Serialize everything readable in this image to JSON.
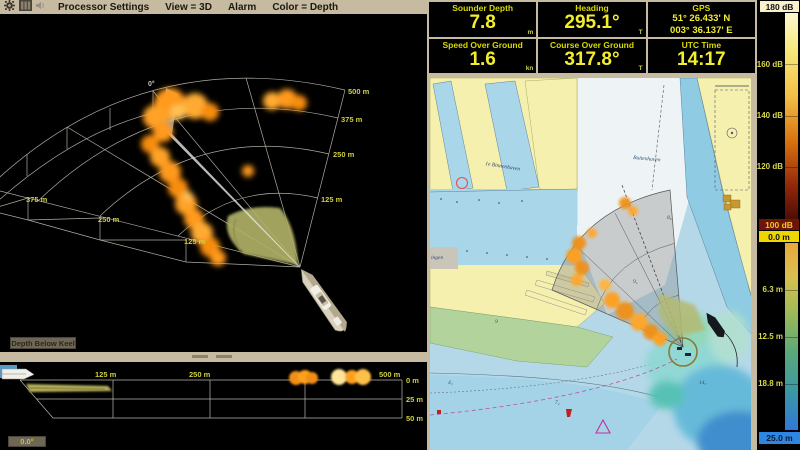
{
  "menu": {
    "items": [
      "Processor Settings",
      "View = 3D",
      "Alarm",
      "Color = Depth"
    ]
  },
  "instruments": {
    "boxes": [
      {
        "label": "Sounder Depth",
        "value": "7.8",
        "unit": "m"
      },
      {
        "label": "Heading",
        "value": "295.1°",
        "unit": "T"
      },
      {
        "label": "GPS",
        "line1": "51° 26.433' N",
        "line2": "003° 36.137' E",
        "unit": ""
      },
      {
        "label": "Speed Over Ground",
        "value": "1.6",
        "unit": "kn"
      },
      {
        "label": "Course Over Ground",
        "value": "317.8°",
        "unit": "T"
      },
      {
        "label": "UTC Time",
        "value": "14:17",
        "unit": ""
      }
    ]
  },
  "sonar3d": {
    "bearing_label": "0°",
    "right_ranges": [
      "500 m",
      "375 m",
      "250 m",
      "125 m"
    ],
    "left_ranges": [
      "375 m",
      "250 m",
      "125 m"
    ],
    "button": "Depth Below Keel"
  },
  "profile": {
    "distance_labels": [
      "125 m",
      "250 m",
      "500 m"
    ],
    "depth_labels": [
      "0 m",
      "25 m",
      "50 m"
    ],
    "button": "0.0°"
  },
  "chart": {
    "labels": {
      "harbor_left": "1e Binnenhaven",
      "harbor_right": "Buitenhaven",
      "town": "ingen"
    },
    "soundings": {
      "s1": "9",
      "s2": "4₃",
      "s3": "7₂",
      "s4": "14₃",
      "s5": "9₂",
      "s6": "8₈"
    }
  },
  "scales": {
    "db": {
      "top": "180 dB",
      "ticks": [
        "160 dB",
        "140 dB",
        "120 dB"
      ],
      "bottom": "100 dB"
    },
    "depth": {
      "top": "0.0 m",
      "ticks": [
        "6.3 m",
        "12.5 m",
        "18.8 m"
      ],
      "bottom": "25.0 m"
    }
  },
  "colors": {
    "panel_tan": "#c6baa1",
    "value_yellow": "#f2ee2e",
    "label_yellow": "#d9d900",
    "range_yellow": "#cfcf3f",
    "sonar_orange": "#ff9a1e",
    "db_top_bg": "#f7f2cc",
    "db_bottom_bg": "#6e1408",
    "depth_top_bg": "#eed600",
    "depth_bottom_bg": "#2e86e0"
  }
}
